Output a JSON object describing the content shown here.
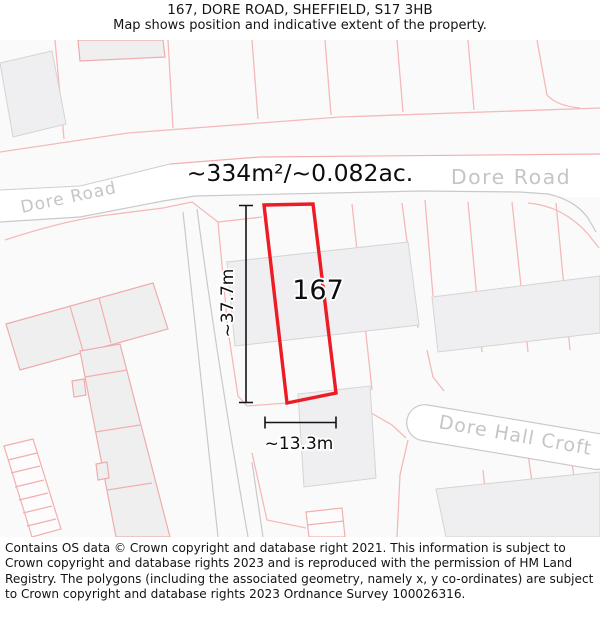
{
  "title": {
    "line1": "167, DORE ROAD, SHEFFIELD, S17 3HB",
    "line2": "Map shows position and indicative extent of the property."
  },
  "map": {
    "area_label": "~334m²/~0.082ac.",
    "plot_number": "167",
    "dim_vertical_label": "~37.7m",
    "dim_horizontal_label": "~13.3m",
    "road_labels": {
      "dore_road_left": "Dore Road",
      "dore_road_center": "Dore Road",
      "dore_hall_croft": "Dore Hall Croft"
    }
  },
  "footer": {
    "copyright": "Contains OS data © Crown copyright and database right 2021. This information is subject to Crown copyright and database rights 2023 and is reproduced with the permission of HM Land Registry. The polygons (including the associated geometry, namely x, y co-ordinates) are subject to Crown copyright and database rights 2023 Ordnance Survey 100026316."
  },
  "colors": {
    "plot_outline_red": "#ed1c24",
    "parcel_line_pink": "#f5b9b9",
    "road_edge_gray": "#c9c9c9",
    "building_fill": "#efeef0",
    "road_label_gray": "#c6c5c6",
    "annotation_black": "#141414"
  }
}
